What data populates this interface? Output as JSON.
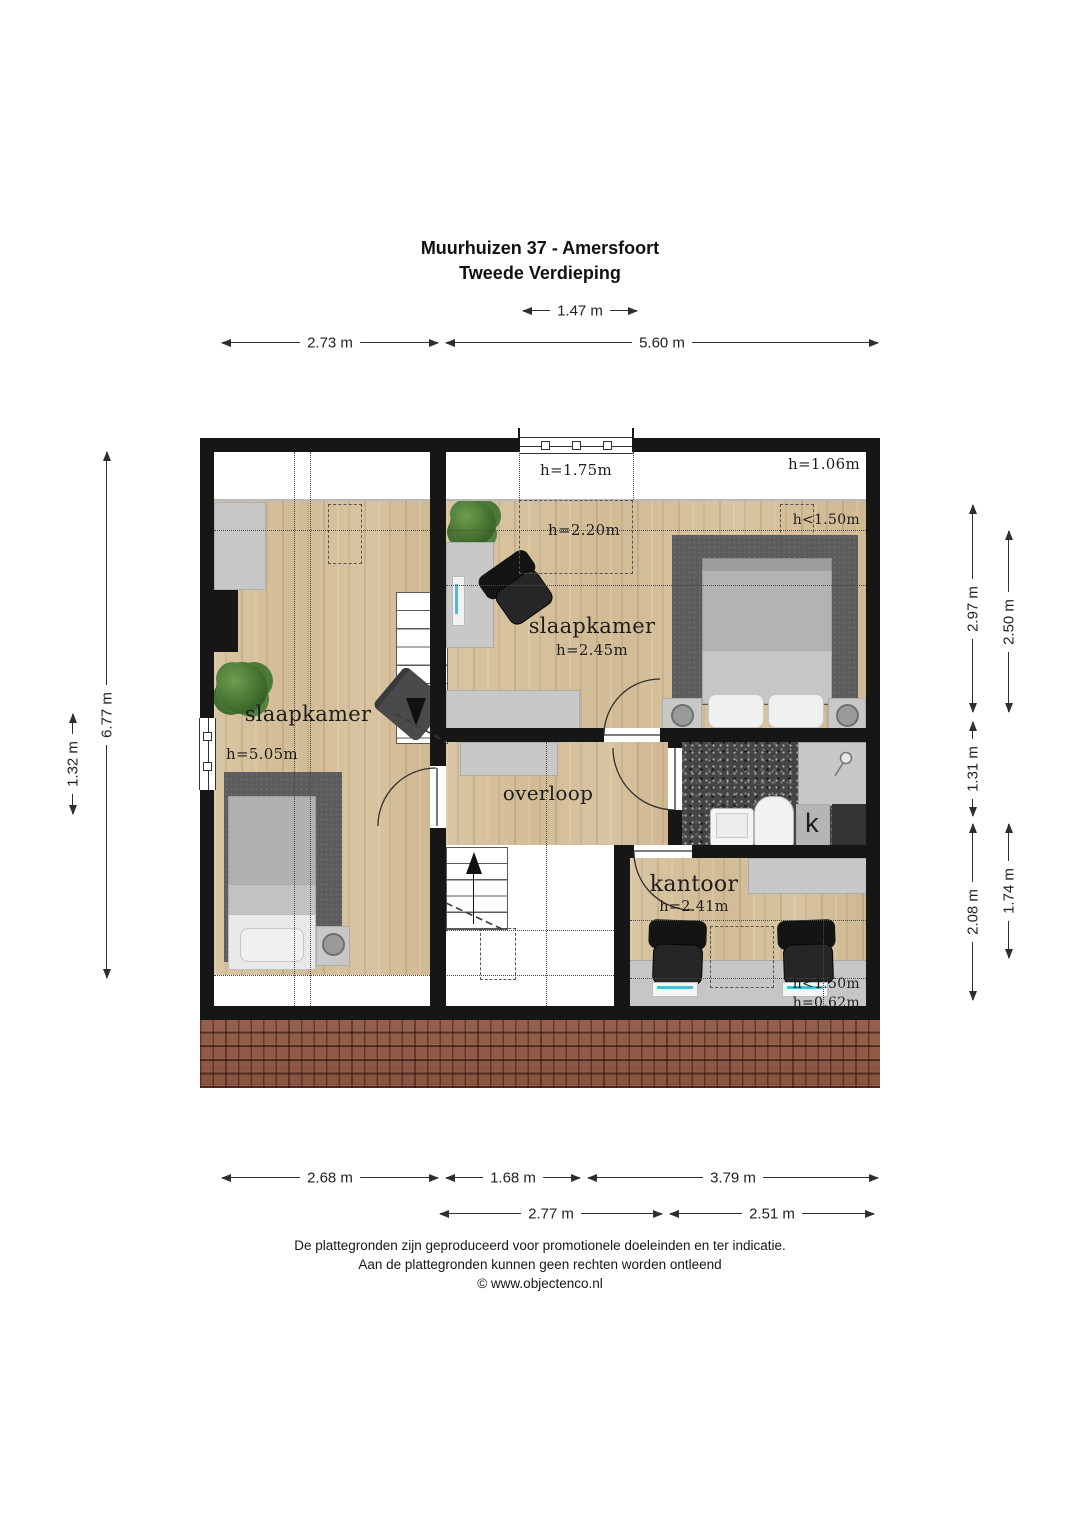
{
  "title": {
    "line1": "Muurhuizen 37 - Amersfoort",
    "line2": "Tweede Verdieping"
  },
  "dimensions": {
    "top": [
      {
        "label": "1.47 m"
      },
      {
        "label": "2.73 m"
      },
      {
        "label": "5.60 m"
      }
    ],
    "left": [
      {
        "label": "6.77 m"
      },
      {
        "label": "1.32 m"
      }
    ],
    "right": [
      {
        "label": "2.97 m"
      },
      {
        "label": "2.50 m"
      },
      {
        "label": "1.31 m"
      },
      {
        "label": "2.08 m"
      },
      {
        "label": "1.74 m"
      }
    ],
    "bottom": [
      {
        "label": "2.68 m"
      },
      {
        "label": "1.68 m"
      },
      {
        "label": "3.79 m"
      },
      {
        "label": "2.77 m"
      },
      {
        "label": "2.51 m"
      }
    ]
  },
  "rooms": {
    "bedroom_left": {
      "name": "slaapkamer",
      "height": "h=5.05m"
    },
    "bedroom_right": {
      "name": "slaapkamer",
      "height": "h=2.45m"
    },
    "landing": {
      "name": "overloop"
    },
    "office": {
      "name": "kantoor",
      "height": "h=2.41m"
    },
    "closet": {
      "label": "k"
    }
  },
  "height_labels": {
    "dormer": "h=1.75m",
    "top_right": "h=1.06m",
    "bedroom_right_upper": "h=2.20m",
    "bedroom_right_knee": "h<1.50m",
    "office_knee": "h<1.50m",
    "office_low": "h=0.62m"
  },
  "footer": {
    "line1": "De plattegronden zijn geproduceerd voor promotionele doeleinden en ter indicatie.",
    "line2": "Aan de plattegronden kunnen geen rechten worden ontleend",
    "line3": "© www.objectenco.nl"
  },
  "colors": {
    "wall": "#161616",
    "wood_floor": "#d7c29e",
    "rug": "#5c5c5c",
    "bathroom_floor": "#454545",
    "roof_tiles": "#8e5945",
    "furniture_gray": "#c8c8c8"
  }
}
